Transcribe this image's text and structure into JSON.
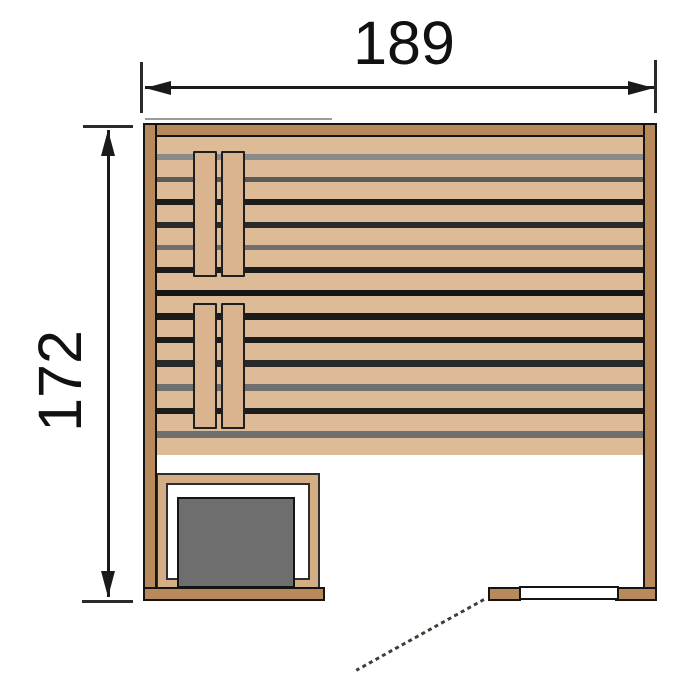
{
  "dimensions": {
    "width": {
      "label": "189"
    },
    "height": {
      "label": "172"
    }
  },
  "diagram": {
    "type": "sauna-floor-plan",
    "colors": {
      "outline": "#141414",
      "dim_line": "#1a1a1a",
      "wall_wood": "#b8895a",
      "plank_wood": "#ddbb96",
      "board_wood": "#d9b48e",
      "guard_wood": "#d3ae85",
      "heater_gray": "#6e6e6e",
      "dash": "#423d34",
      "shadow_gray": "#9b9b9b"
    },
    "benches": {
      "upper": {
        "planks": 7,
        "plank_height": 17,
        "gap_colors": [
          "#8a8a8a",
          "#5a5a5a",
          "#1c1c1c",
          "#2a2a2a",
          "#6f6f6f",
          "#1c1c1c"
        ]
      },
      "lower": {
        "planks": 7,
        "plank_height": 17,
        "gap_colors": [
          "#1c1c1c",
          "#1c1c1c",
          "#2a2a2a",
          "#6f6f6f",
          "#1c1c1c",
          "#6f6f6f"
        ]
      }
    }
  }
}
